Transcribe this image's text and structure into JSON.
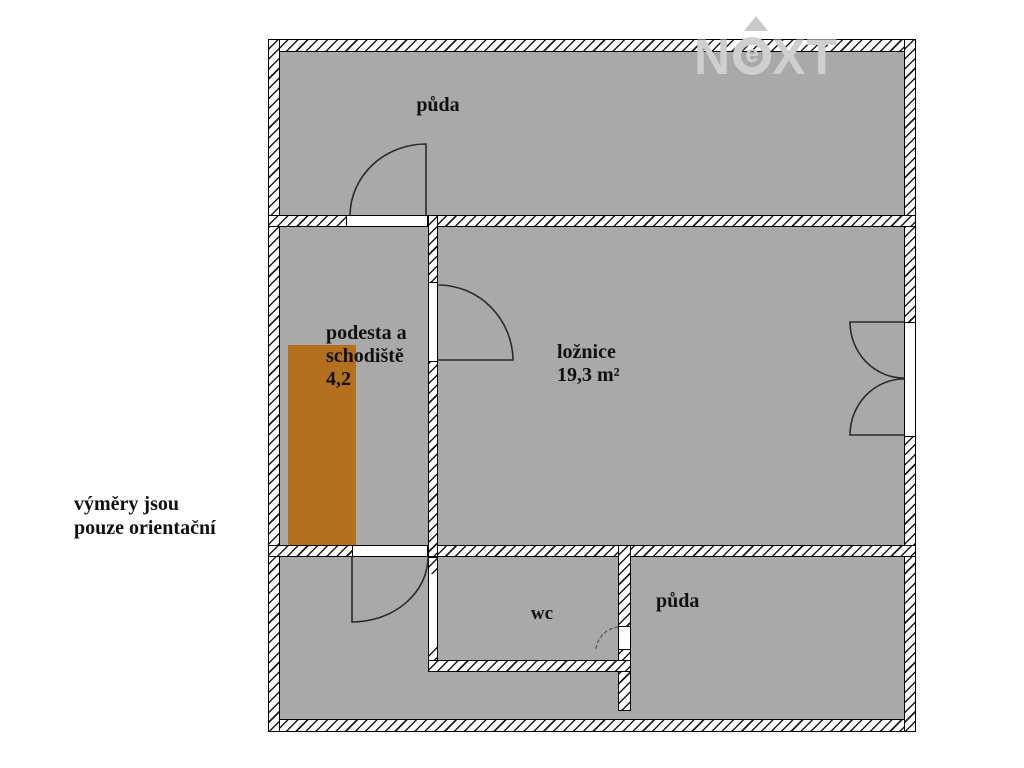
{
  "page": {
    "background": "#ffffff",
    "type": "floor-plan"
  },
  "plan": {
    "floor_color": "#a9a9a9",
    "wall_fill": "#ffffff",
    "wall_hatch_color": "#1b1b1b",
    "stairs_color": "#b3701e",
    "rooms": [
      {
        "id": "attic-top",
        "label": "půda"
      },
      {
        "id": "landing-staircase",
        "label": "podesta a schodiště",
        "area": "4,2"
      },
      {
        "id": "bedroom",
        "label": "ložnice",
        "area": "19,3 m²"
      },
      {
        "id": "wc",
        "label": "wc"
      },
      {
        "id": "attic-bottom",
        "label": "půda"
      }
    ]
  },
  "labels": {
    "attic_top": "půda",
    "landing_line1": "podesta a",
    "landing_line2": "schodiště",
    "landing_area": "4,2",
    "bedroom_name": "ložnice",
    "bedroom_area": "19,3 m²",
    "wc": "wc",
    "attic_bottom": "půda",
    "disclaimer_line1": "výměry jsou",
    "disclaimer_line2": "pouze orientační"
  },
  "watermark": {
    "letter_n": "N",
    "letter_e": "e",
    "letter_x": "X",
    "letter_t": "T",
    "color": "#cfcfcf"
  }
}
